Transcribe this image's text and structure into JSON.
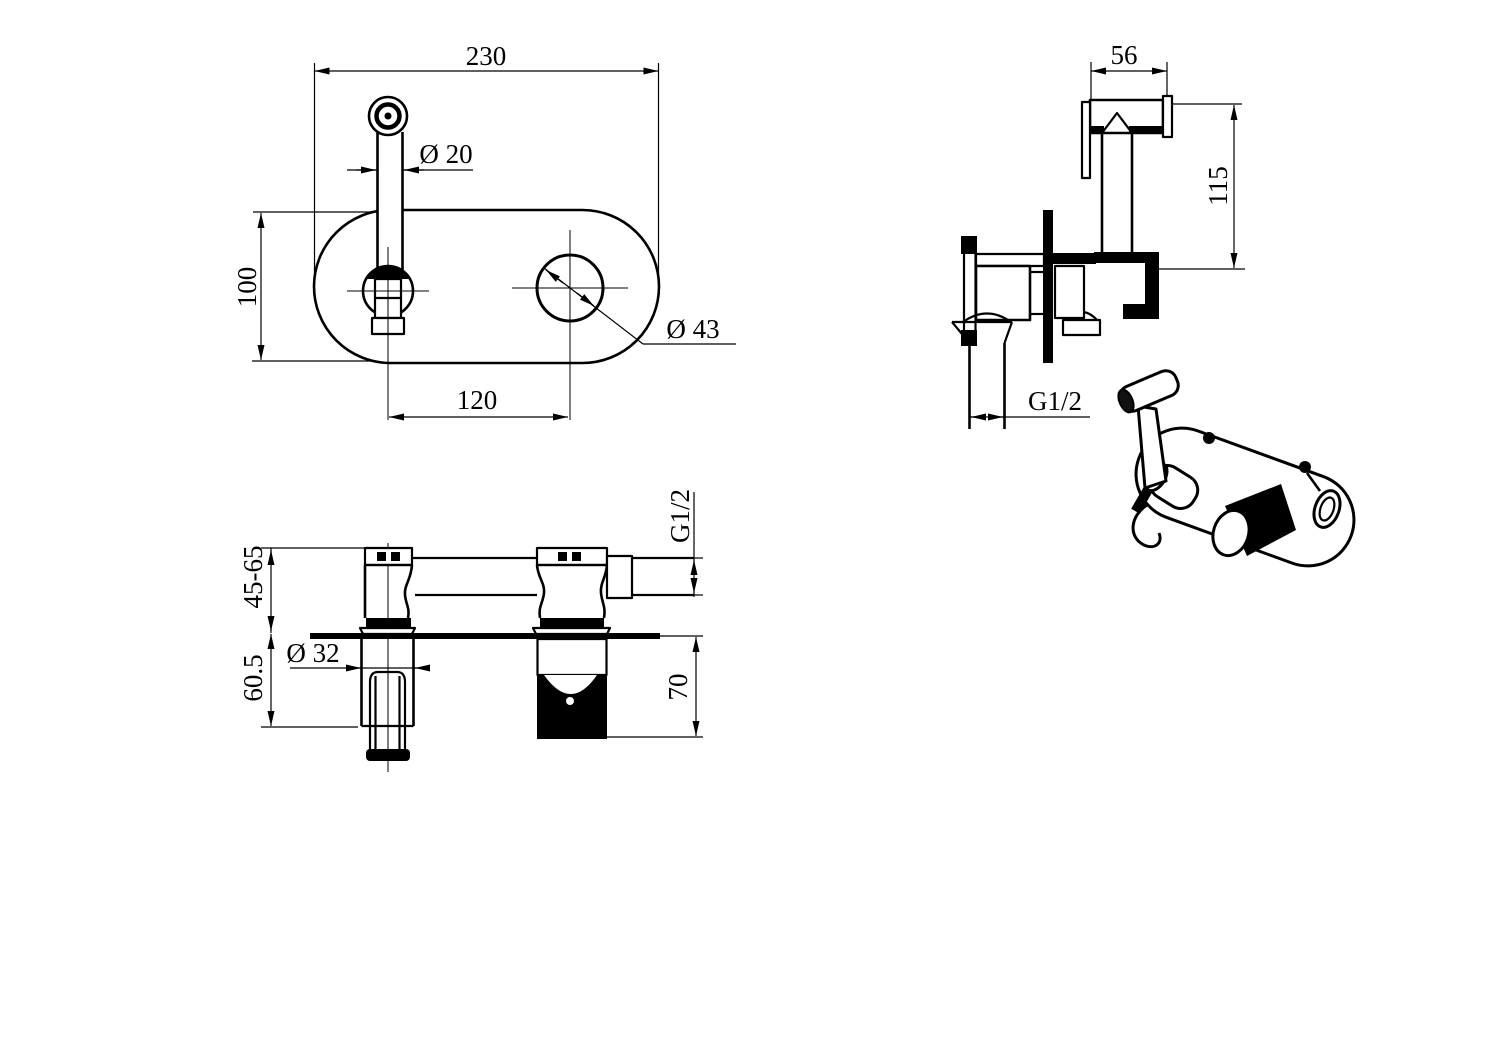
{
  "palette": {
    "paper": "#ffffff",
    "ink": "#000000"
  },
  "dims": {
    "front_plate_width": "230",
    "front_spray_diameter": "Ø 20",
    "front_plate_height": "100",
    "front_hole_spacing": "120",
    "front_mixer_hole_diameter": "Ø 43",
    "side_head_width": "56",
    "side_sprayer_height": "115",
    "side_outlet_thread": "G1/2",
    "section_wall_depth_range": "45-65",
    "section_behind_wall_depth": "60.5",
    "section_sleeve_diameter": "Ø 32",
    "section_valve_depth": "70",
    "section_inlet_thread": "G1/2"
  }
}
